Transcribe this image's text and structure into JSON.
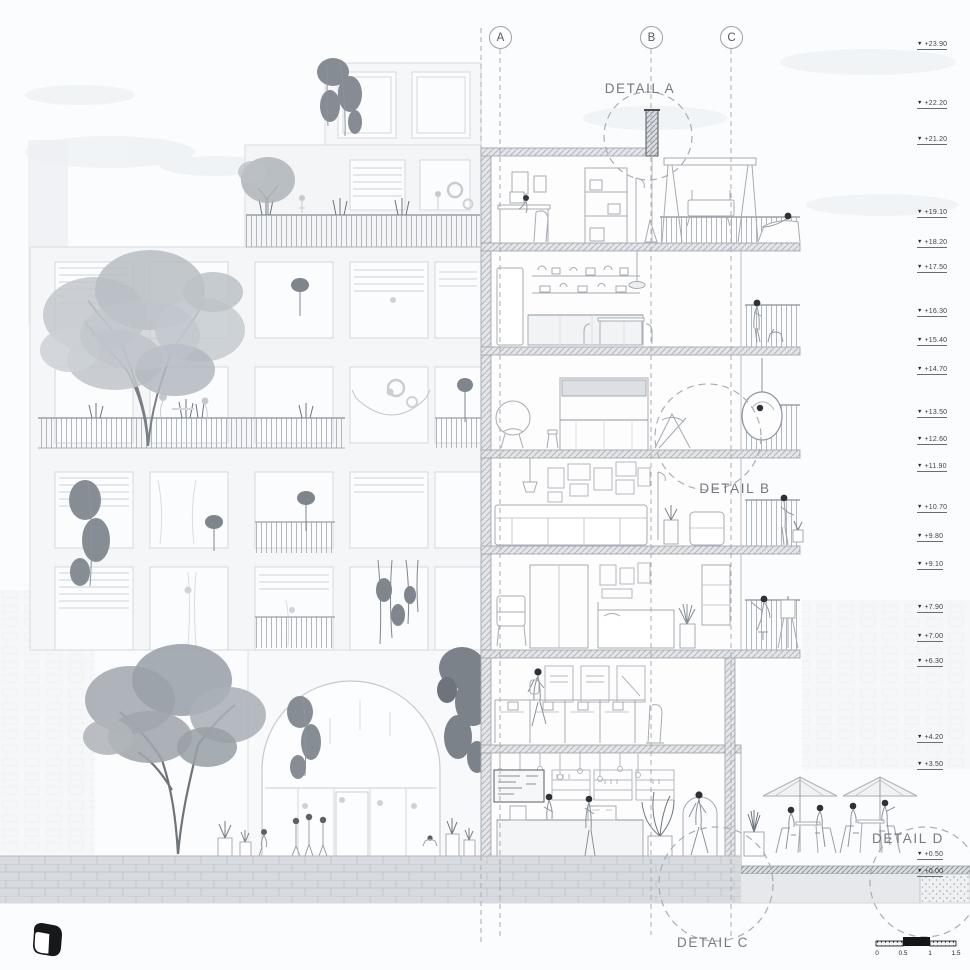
{
  "grid_axes": [
    {
      "label": "A"
    },
    {
      "label": "B"
    },
    {
      "label": "C"
    }
  ],
  "detail_callouts": {
    "a": "DETAIL A",
    "b": "DETAIL B",
    "c": "DETAIL C",
    "d": "DETAIL D"
  },
  "elevation_markers": [
    {
      "value": "+23.90"
    },
    {
      "value": "+22.20"
    },
    {
      "value": "+21.20"
    },
    {
      "value": "+19.10"
    },
    {
      "value": "+18.20"
    },
    {
      "value": "+17.50"
    },
    {
      "value": "+16.30"
    },
    {
      "value": "+15.40"
    },
    {
      "value": "+14.70"
    },
    {
      "value": "+13.50"
    },
    {
      "value": "+12.60"
    },
    {
      "value": "+11.90"
    },
    {
      "value": "+10.70"
    },
    {
      "value": "+9.80"
    },
    {
      "value": "+9.10"
    },
    {
      "value": "+7.90"
    },
    {
      "value": "+7.00"
    },
    {
      "value": "+6.30"
    },
    {
      "value": "+4.20"
    },
    {
      "value": "+3.50"
    },
    {
      "value": "+0.50"
    },
    {
      "value": "+0.00"
    }
  ],
  "scale_bar": {
    "labels": [
      "0",
      "0.5",
      "1",
      "1.5"
    ]
  },
  "colors": {
    "line_light": "#ccd0d5",
    "line_mid": "#aab0b6",
    "line_dark": "#8d939a",
    "ink": "#34373c",
    "slab_fill": "#e3e5e8",
    "detail_text": "#77797e",
    "black": "#17181a"
  }
}
